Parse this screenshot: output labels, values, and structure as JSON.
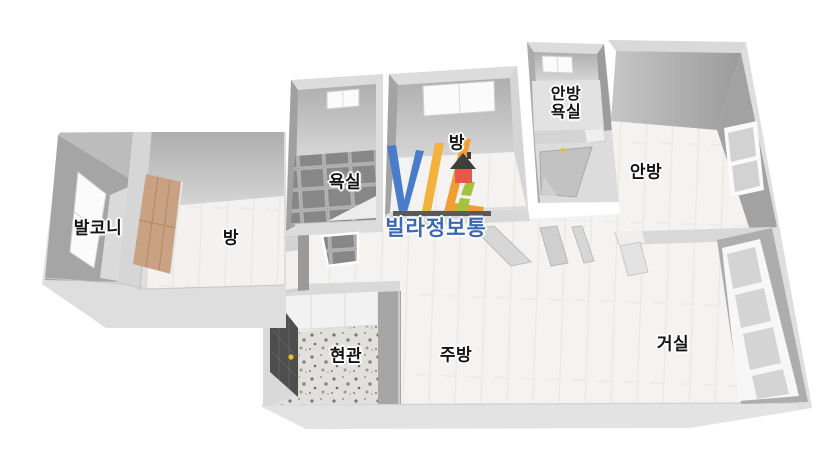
{
  "title": "3d-floor-plan",
  "labels": {
    "balcony": "발코니",
    "room_left": "방",
    "bathroom": "욕실",
    "room_top": "방",
    "master_bath_l1": "안방",
    "master_bath_l2": "욕실",
    "master_bedroom": "안방",
    "entrance": "현관",
    "kitchen": "주방",
    "living_room": "거실"
  },
  "watermark": {
    "logo_text": "VILI",
    "brand": "빌라정보통",
    "colors": {
      "letter_v": "#4a7dc9",
      "letter_i1": "#f2b23c",
      "letter_l": "#f09e33",
      "letter_i2": "#a2c43d",
      "house_body": "#e8584b",
      "house_roof": "#3e3e3e",
      "underline_bar": "#595959",
      "brand_text": "#3b68b2"
    }
  },
  "palette": {
    "background": "#ffffff",
    "wall_top": "#dedede",
    "wall_face_dark": "#a0a0a0",
    "floor_wood": "#f4f3f1",
    "bathroom_tile": "#8e8e8e",
    "closet_wood": "#c8a283",
    "entrance_door": "#4e4e4e",
    "door_knob": "#e9c227"
  }
}
